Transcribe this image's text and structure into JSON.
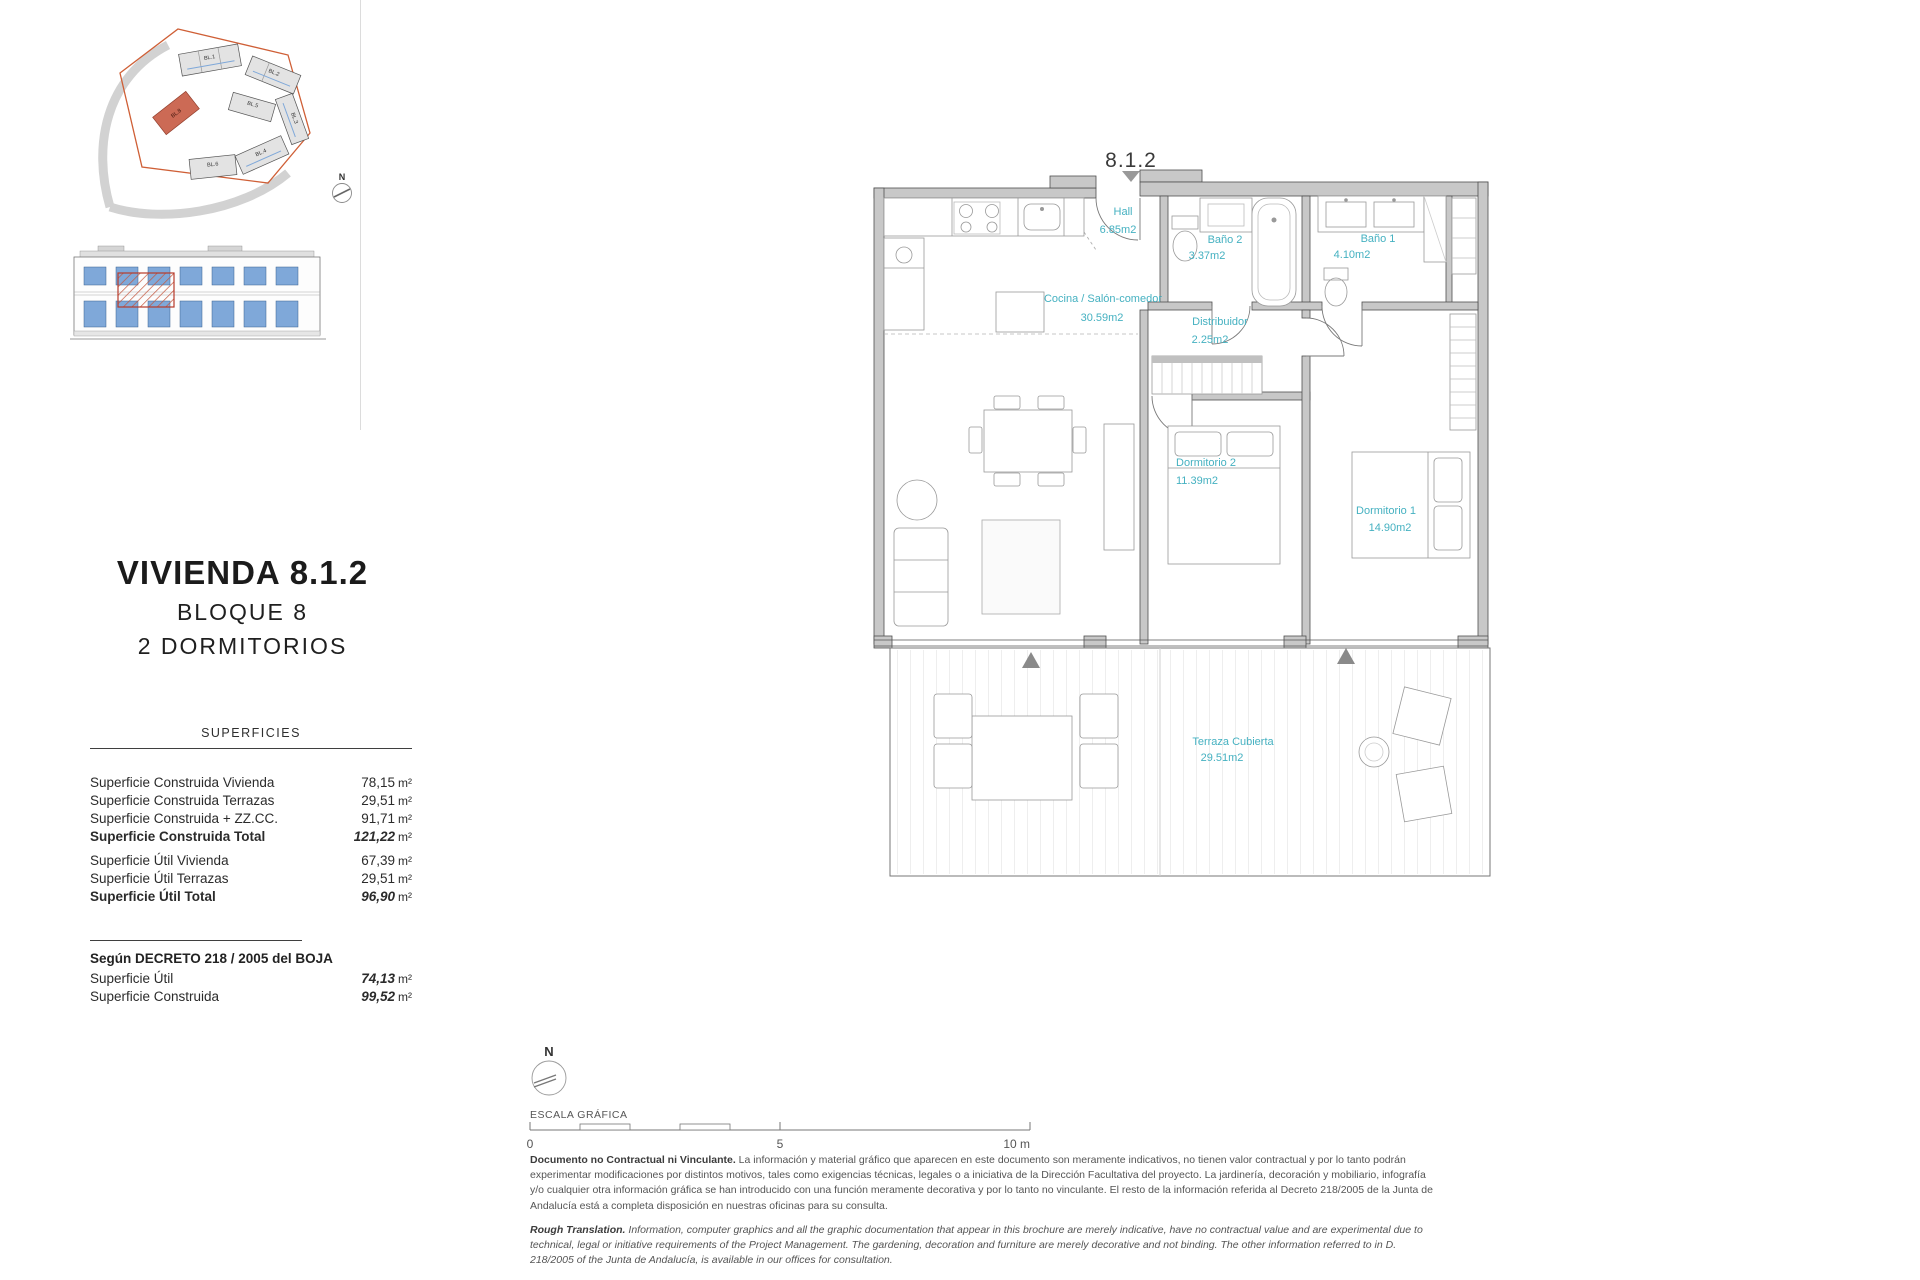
{
  "site_plan": {
    "north_label": "N",
    "blocks": [
      "BL.1",
      "BL.2",
      "BL.3",
      "BL.4",
      "BL.5",
      "BL.6",
      "BL.8"
    ]
  },
  "title_block": {
    "title": "VIVIENDA 8.1.2",
    "subtitle1": "BLOQUE 8",
    "subtitle2": "2 DORMITORIOS"
  },
  "superficies": {
    "header": "SUPERFICIES",
    "groups": [
      {
        "rows": [
          {
            "label": "Superficie Construida Vivienda",
            "value": "78,15",
            "unit": "m²"
          },
          {
            "label": "Superficie Construida Terrazas",
            "value": "29,51",
            "unit": "m²"
          },
          {
            "label": "Superficie Construida + ZZ.CC.",
            "value": "91,71",
            "unit": "m²"
          },
          {
            "label": "Superficie Construida Total",
            "value": "121,22",
            "unit": "m²"
          }
        ]
      },
      {
        "rows": [
          {
            "label": "Superficie Útil Vivienda",
            "value": "67,39",
            "unit": "m²"
          },
          {
            "label": "Superficie Útil Terrazas",
            "value": "29,51",
            "unit": "m²"
          },
          {
            "label": "Superficie Útil Total",
            "value": "96,90",
            "unit": "m²"
          }
        ]
      }
    ]
  },
  "decreto": {
    "title": "Según DECRETO 218 / 2005 del BOJA",
    "rows": [
      {
        "label": "Superficie Útil",
        "value": "74,13",
        "unit": "m²"
      },
      {
        "label": "Superficie Construida",
        "value": "99,52",
        "unit": "m²"
      }
    ]
  },
  "floor_plan": {
    "marker": "8.1.2",
    "label_color": "#45b1c1",
    "wall_color": "#c8c8c8",
    "rooms": [
      {
        "name": "Hall",
        "area": "6.85m2"
      },
      {
        "name": "Baño 2",
        "area": "3.37m2"
      },
      {
        "name": "Baño 1",
        "area": "4.10m2"
      },
      {
        "name": "Cocina / Salón-comedor",
        "area": "30.59m2"
      },
      {
        "name": "Distribuidor",
        "area": "2.25m2"
      },
      {
        "name": "Dormitorio 2",
        "area": "11.39m2"
      },
      {
        "name": "Dormitorio 1",
        "area": "14.90m2"
      },
      {
        "name": "Terraza Cubierta",
        "area": "29.51m2"
      }
    ]
  },
  "footer": {
    "north_label": "N",
    "scale_label": "ESCALA GRÁFICA",
    "scale_ticks": [
      "0",
      "5",
      "10 m"
    ],
    "disclaimer_es_lead": "Documento no Contractual ni Vinculante.",
    "disclaimer_es": "La información y material gráfico que aparecen en este documento son meramente indicativos, no tienen valor contractual y por lo tanto podrán experimentar modificaciones por distintos motivos, tales como exigencias técnicas, legales o a iniciativa de la Dirección Facultativa del proyecto. La jardinería, decoración y mobiliario, infografía y/o cualquier otra información gráfica se han introducido con una función meramente decorativa y por lo tanto no vinculante. El resto de la información referida al Decreto 218/2005 de la Junta de Andalucía está a completa disposición en nuestras oficinas para su consulta.",
    "disclaimer_en_lead": "Rough Translation.",
    "disclaimer_en": "Information, computer graphics and all the graphic documentation that appear in this brochure are merely indicative, have no contractual value and are experimental due to technical, legal or initiative requirements of the Project Management. The gardening, decoration and furniture are merely decorative and not binding. The other information referred to in D. 218/2005 of the Junta de Andalucía, is available in our offices for consultation."
  }
}
